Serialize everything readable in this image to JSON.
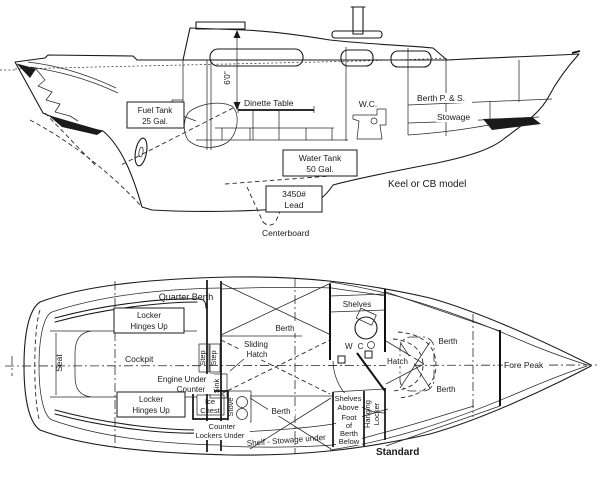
{
  "colors": {
    "ink": "#1a1a1a",
    "paper": "#ffffff"
  },
  "profile": {
    "labels": {
      "fuel_tank": [
        "Fuel Tank",
        "25 Gal."
      ],
      "headroom": "6'0''",
      "dinette_table": "Dinette Table",
      "wc": "W.C.",
      "berth_ps": "Berth P. & S.",
      "stowage": "Stowage",
      "water_tank": [
        "Water Tank",
        "50 Gal."
      ],
      "keel_note": "Keel or CB model",
      "ballast": [
        "3450#",
        "Lead"
      ],
      "centerboard": "Centerboard"
    }
  },
  "plan": {
    "labels": {
      "quarter_berth": "Quarter Berth",
      "locker_aft": [
        "Locker",
        "Hinges Up"
      ],
      "seat": "Seat",
      "cockpit": "Cockpit",
      "step_1": "Step",
      "step_2": "Step",
      "sliding_hatch": [
        "Sliding",
        "Hatch"
      ],
      "engine_under": "Engine Under",
      "counter": "Counter",
      "sink": "Sink",
      "locker_fwd": [
        "Locker",
        "Hinges Up"
      ],
      "ice_chest": [
        "Ice",
        "Chest"
      ],
      "stove": "Stove",
      "counter_lockers": [
        "Counter",
        "Lockers Under"
      ],
      "berth_main_top": "Berth",
      "berth_main_bottom": "Berth",
      "shelf_stowage": "Shelf - Stowage under",
      "shelves": "Shelves",
      "wc": "W C",
      "hatch": "Hatch",
      "berth_fwd_top": "Berth",
      "berth_fwd_bottom": "Berth",
      "fore_peak": "Fore Peak",
      "shelves_above": [
        "Shelves",
        "Above"
      ],
      "foot_of_berth": [
        "Foot",
        "of",
        "Berth",
        "Below"
      ],
      "hanging_locker": [
        "Hanging",
        "Locker"
      ],
      "standard": "Standard"
    }
  }
}
